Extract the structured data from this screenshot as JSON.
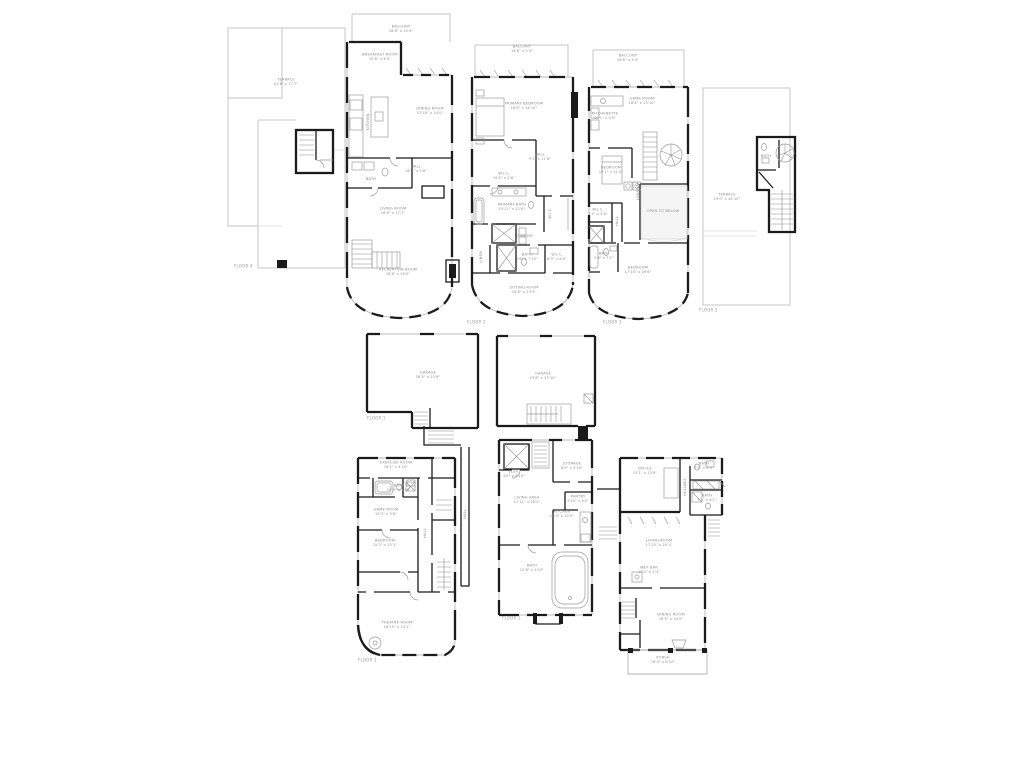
{
  "colors": {
    "wall": "#1b1b1b",
    "outline_gray": "#c6c6c6",
    "label_gray": "#8a8a8a"
  },
  "plans": {
    "roof": {
      "floor_label": "FLOOR 4",
      "terrace": {
        "name": "TERRACE",
        "dims": "21'6\" x 17'7\""
      }
    },
    "living": {
      "balcony": {
        "name": "BALCONY",
        "dims": "16'8\" x 10'4\""
      },
      "breakfast": {
        "name": "BREAKFAST ROOM",
        "dims": "10'8\" x 8'0\""
      },
      "dining": {
        "name": "DINING ROOM",
        "dims": "13'10\" x 14'0\""
      },
      "kitchen": {
        "name": "KITCHEN"
      },
      "bath": {
        "name": "BATH"
      },
      "hall": {
        "name": "HALL",
        "dims": "16'0\" x 4'6\""
      },
      "living_room": {
        "name": "LIVING ROOM",
        "dims": "16'8\" x 17'7\""
      },
      "recreation": {
        "name": "RECREATION ROOM",
        "dims": "16'8\" x 19'0\""
      }
    },
    "primary": {
      "floor_label": "FLOOR 2",
      "balcony": {
        "name": "BALCONY",
        "dims": "16'8\" x 5'4\""
      },
      "bedroom": {
        "name": "PRIMARY BEDROOM",
        "dims": "16'8\" x 14'10\""
      },
      "hall": {
        "name": "HALL",
        "dims": "9'2\" x 11'8\""
      },
      "wic1": {
        "name": "W.I.C.",
        "dims": "10'2\" x 2'8\""
      },
      "bath": {
        "name": "PRIMARY BATH",
        "dims": "10'11\" x 11'6\""
      },
      "wic2": {
        "name": "W.I.C."
      },
      "laundry": {
        "name": "LAUNDRY"
      },
      "bath2": {
        "name": "BATH",
        "dims": "5'6\" x 7'10\""
      },
      "wic3": {
        "name": "W.I.C.",
        "dims": "8'0\" x 6'0\""
      },
      "linen": {
        "name": "LINEN"
      },
      "sitting": {
        "name": "SITTING ROOM",
        "dims": "16'8\" x 13'0\""
      }
    },
    "game": {
      "floor_label": "FLOOR 3",
      "balcony": {
        "name": "BALCONY",
        "dims": "16'8\" x 5'4\""
      },
      "game_room": {
        "name": "GAME ROOM",
        "dims": "16'8\" x 13'10\""
      },
      "kitchenette": {
        "name": "KITCHENETTE",
        "dims": "10'1\" x 3'0\""
      },
      "bedroom1": {
        "name": "BEDROOM",
        "dims": "10'1\" x 11'0\""
      },
      "laundry": {
        "name": "LAUNDRY"
      },
      "wic": {
        "name": "W.I.C.",
        "dims": "3'1\" x 5'0\""
      },
      "hall": {
        "name": "HALL"
      },
      "open_below": {
        "name": "OPEN TO BELOW"
      },
      "bath": {
        "name": "BATH",
        "dims": "5'6\" x 7'1\""
      },
      "bedroom2": {
        "name": "BEDROOM",
        "dims": "17'10\" x 16'6\""
      }
    },
    "roof_upper": {
      "floor_label": "FLOOR 5",
      "terrace": {
        "name": "TERRACE",
        "dims": "19'0\" x 44'10\""
      },
      "bath": {
        "name": "BATH"
      }
    },
    "garage": {
      "floor_label": "FLOOR 1",
      "garage_west": {
        "name": "GARAGE",
        "dims": "26'5\" x 23'8\""
      },
      "garage_east": {
        "name": "GARAGE",
        "dims": "19'8\" x 23'10\""
      },
      "hall": {
        "name": "HALL"
      }
    },
    "basement": {
      "floor_label": "FLOOR 1",
      "exercise": {
        "name": "EXERCISE ROOM",
        "dims": "16'1\" x 4'10\""
      },
      "bath": {
        "name": "BATH",
        "dims": "10'1\" x 5'10\""
      },
      "game_room": {
        "name": "GAME ROOM",
        "dims": "15'3\" x 9'8\""
      },
      "bedroom": {
        "name": "BEDROOM",
        "dims": "15'3\" x 10'1\""
      },
      "hall": {
        "name": "HALL"
      },
      "theatre": {
        "name": "THEATRE ROOM",
        "dims": "16'10\" x 14'1\""
      }
    },
    "guest_center": {
      "floor_label": "FLOOR 1",
      "elev": {
        "name": "ELEV.",
        "dims": "4'0\" x 4'10\""
      },
      "storage": {
        "name": "STORAGE",
        "dims": "8'0\" x 4'10\""
      },
      "living_area": {
        "name": "LIVING AREA",
        "dims": "11'11\" x 18'0\""
      },
      "pantry": {
        "name": "PANTRY",
        "dims": "3'10\" x 6'0\""
      },
      "kitchen": {
        "name": "KITCHEN",
        "dims": "10'0\" x 10'0\""
      },
      "bath": {
        "name": "BATH",
        "dims": "12'8\" x 13'0\""
      }
    },
    "guest_east": {
      "office": {
        "name": "OFFICE",
        "dims": "13'1\" x 13'8\""
      },
      "bath1": {
        "name": "BATH",
        "dims": "7'0\" x 6'0\""
      },
      "bath2": {
        "name": "BATH",
        "dims": "7'1\" x 6'1\""
      },
      "hallway": {
        "name": "HALLWAY",
        "dims": "3'1\" x 14'1\""
      },
      "living_room": {
        "name": "LIVING ROOM",
        "dims": "17'10\" x 20'1\""
      },
      "wet_bar": {
        "name": "WET BAR",
        "dims": "10'0\" x 2'1\""
      },
      "dining": {
        "name": "DINING ROOM",
        "dims": "16'0\" x 14'0\""
      },
      "porch": {
        "name": "PORCH",
        "dims": "16'0\" x 6'10\""
      }
    }
  }
}
